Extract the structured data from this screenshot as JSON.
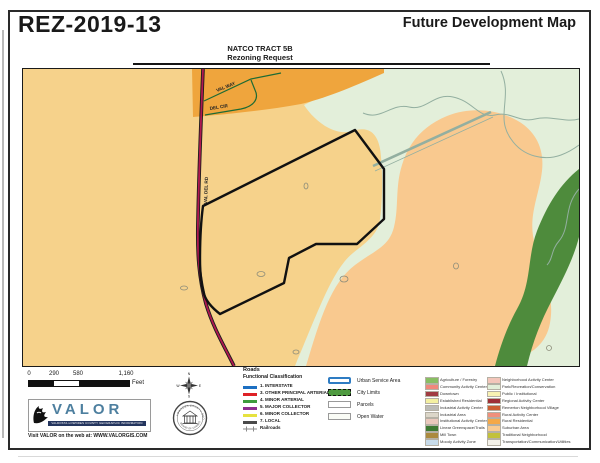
{
  "header": {
    "doc_id": "REZ-2019-13",
    "map_type": "Future Development Map",
    "tract": "NATCO TRACT 5B",
    "request": "Rezoning Request"
  },
  "map": {
    "street_labels": {
      "road": "VAL DEL RD",
      "way": "VAL WAY",
      "circle": "DEL CIR"
    },
    "colors": {
      "base_tan": "#F6D28B",
      "suburban_peach": "#F9C98F",
      "subdivision_orange": "#EFA53D",
      "pale_green": "#E3EFDA",
      "greenspace_dark": "#4E8B3C",
      "stream": "#93AFA0",
      "road_core": "#B01850",
      "road_casing": "#1C1C1C",
      "street_green": "#1E6B34",
      "parcel_outline": "#111111",
      "pond_outline": "#8C8C7A"
    }
  },
  "scale_bar": {
    "ticks": [
      "0",
      "290",
      "580",
      "1,160"
    ],
    "unit": "Feet"
  },
  "compass": {
    "n": "N",
    "e": "E",
    "s": "S",
    "w": "W"
  },
  "seal": {
    "arc_top": "LOWNDES COUNTY GEORGIA",
    "arc_bottom": "BOARD OF COMMISSIONERS"
  },
  "valor": {
    "name": "VALOR",
    "tagline": "VALDOSTA-LOWNDES COUNTY GEOGRAPHIC INFORMATION SYSTEM",
    "website": "Visit VALOR on the web at: WWW.VALORGIS.COM"
  },
  "legend": {
    "roads_title": "Roads",
    "roads_subtitle": "Functional Classification",
    "road_classes": [
      {
        "label": "1. INTERSTATE",
        "color": "#1D6FC2"
      },
      {
        "label": "3. OTHER PRINCIPAL ARTERIAL",
        "color": "#DE2126"
      },
      {
        "label": "4. MINOR ARTERIAL",
        "color": "#3E9B3E"
      },
      {
        "label": "5. MAJOR COLLECTOR",
        "color": "#8E2D90"
      },
      {
        "label": "6. MINOR COLLECTOR",
        "color": "#E6E23F"
      },
      {
        "label": "7. LOCAL",
        "color": "#4A4A4A"
      }
    ],
    "railroads": {
      "label": "Railroads",
      "color": "#8A8A8A"
    },
    "boundaries": [
      {
        "label": "Urban Service Area",
        "border": "#2E7CC3",
        "fill": "#FFFFFF"
      },
      {
        "label": "City Limits",
        "border": "#111111",
        "fill": "#4E9A3F"
      },
      {
        "label": "Parcels",
        "border": "#999999",
        "fill": "#FFFFFF"
      },
      {
        "label": "Open Water",
        "border": "#999999",
        "fill": "#FAFCF6"
      }
    ],
    "land_use_col1": [
      {
        "label": "Agriculture / Forestry",
        "color": "#88BE63"
      },
      {
        "label": "Community Activity Center",
        "color": "#F0887B"
      },
      {
        "label": "Downtown",
        "color": "#A13C42"
      },
      {
        "label": "Established Residential",
        "color": "#F4F0A1"
      },
      {
        "label": "Industrial Activity Center",
        "color": "#BBBBB7"
      },
      {
        "label": "Industrial Area",
        "color": "#DCD6C8"
      },
      {
        "label": "Institutional Activity Center",
        "color": "#EBC8BC"
      },
      {
        "label": "Linear Greenspace/Trails",
        "color": "#3F7A33"
      },
      {
        "label": "Mill Town",
        "color": "#AB8A3E"
      },
      {
        "label": "Moody Activity Zone",
        "color": "#C7DBEA"
      }
    ],
    "land_use_col2": [
      {
        "label": "Neighborhood Activity Center",
        "color": "#F3C6BA"
      },
      {
        "label": "Park/Recreation/Conservation",
        "color": "#E2EFD9"
      },
      {
        "label": "Public / Institutional",
        "color": "#F8F2B3"
      },
      {
        "label": "Regional Activity Center",
        "color": "#9E3038"
      },
      {
        "label": "Remerton Neighborhood Village",
        "color": "#CC5F33"
      },
      {
        "label": "Rural Activity Center",
        "color": "#F0907C"
      },
      {
        "label": "Rural Residential",
        "color": "#F4A847"
      },
      {
        "label": "Suburban Area",
        "color": "#F9CB92"
      },
      {
        "label": "Traditional Neighborhood",
        "color": "#C2C13B"
      },
      {
        "label": "Transportation/Communication/Utilities",
        "color": "#F4F2EA"
      }
    ]
  }
}
